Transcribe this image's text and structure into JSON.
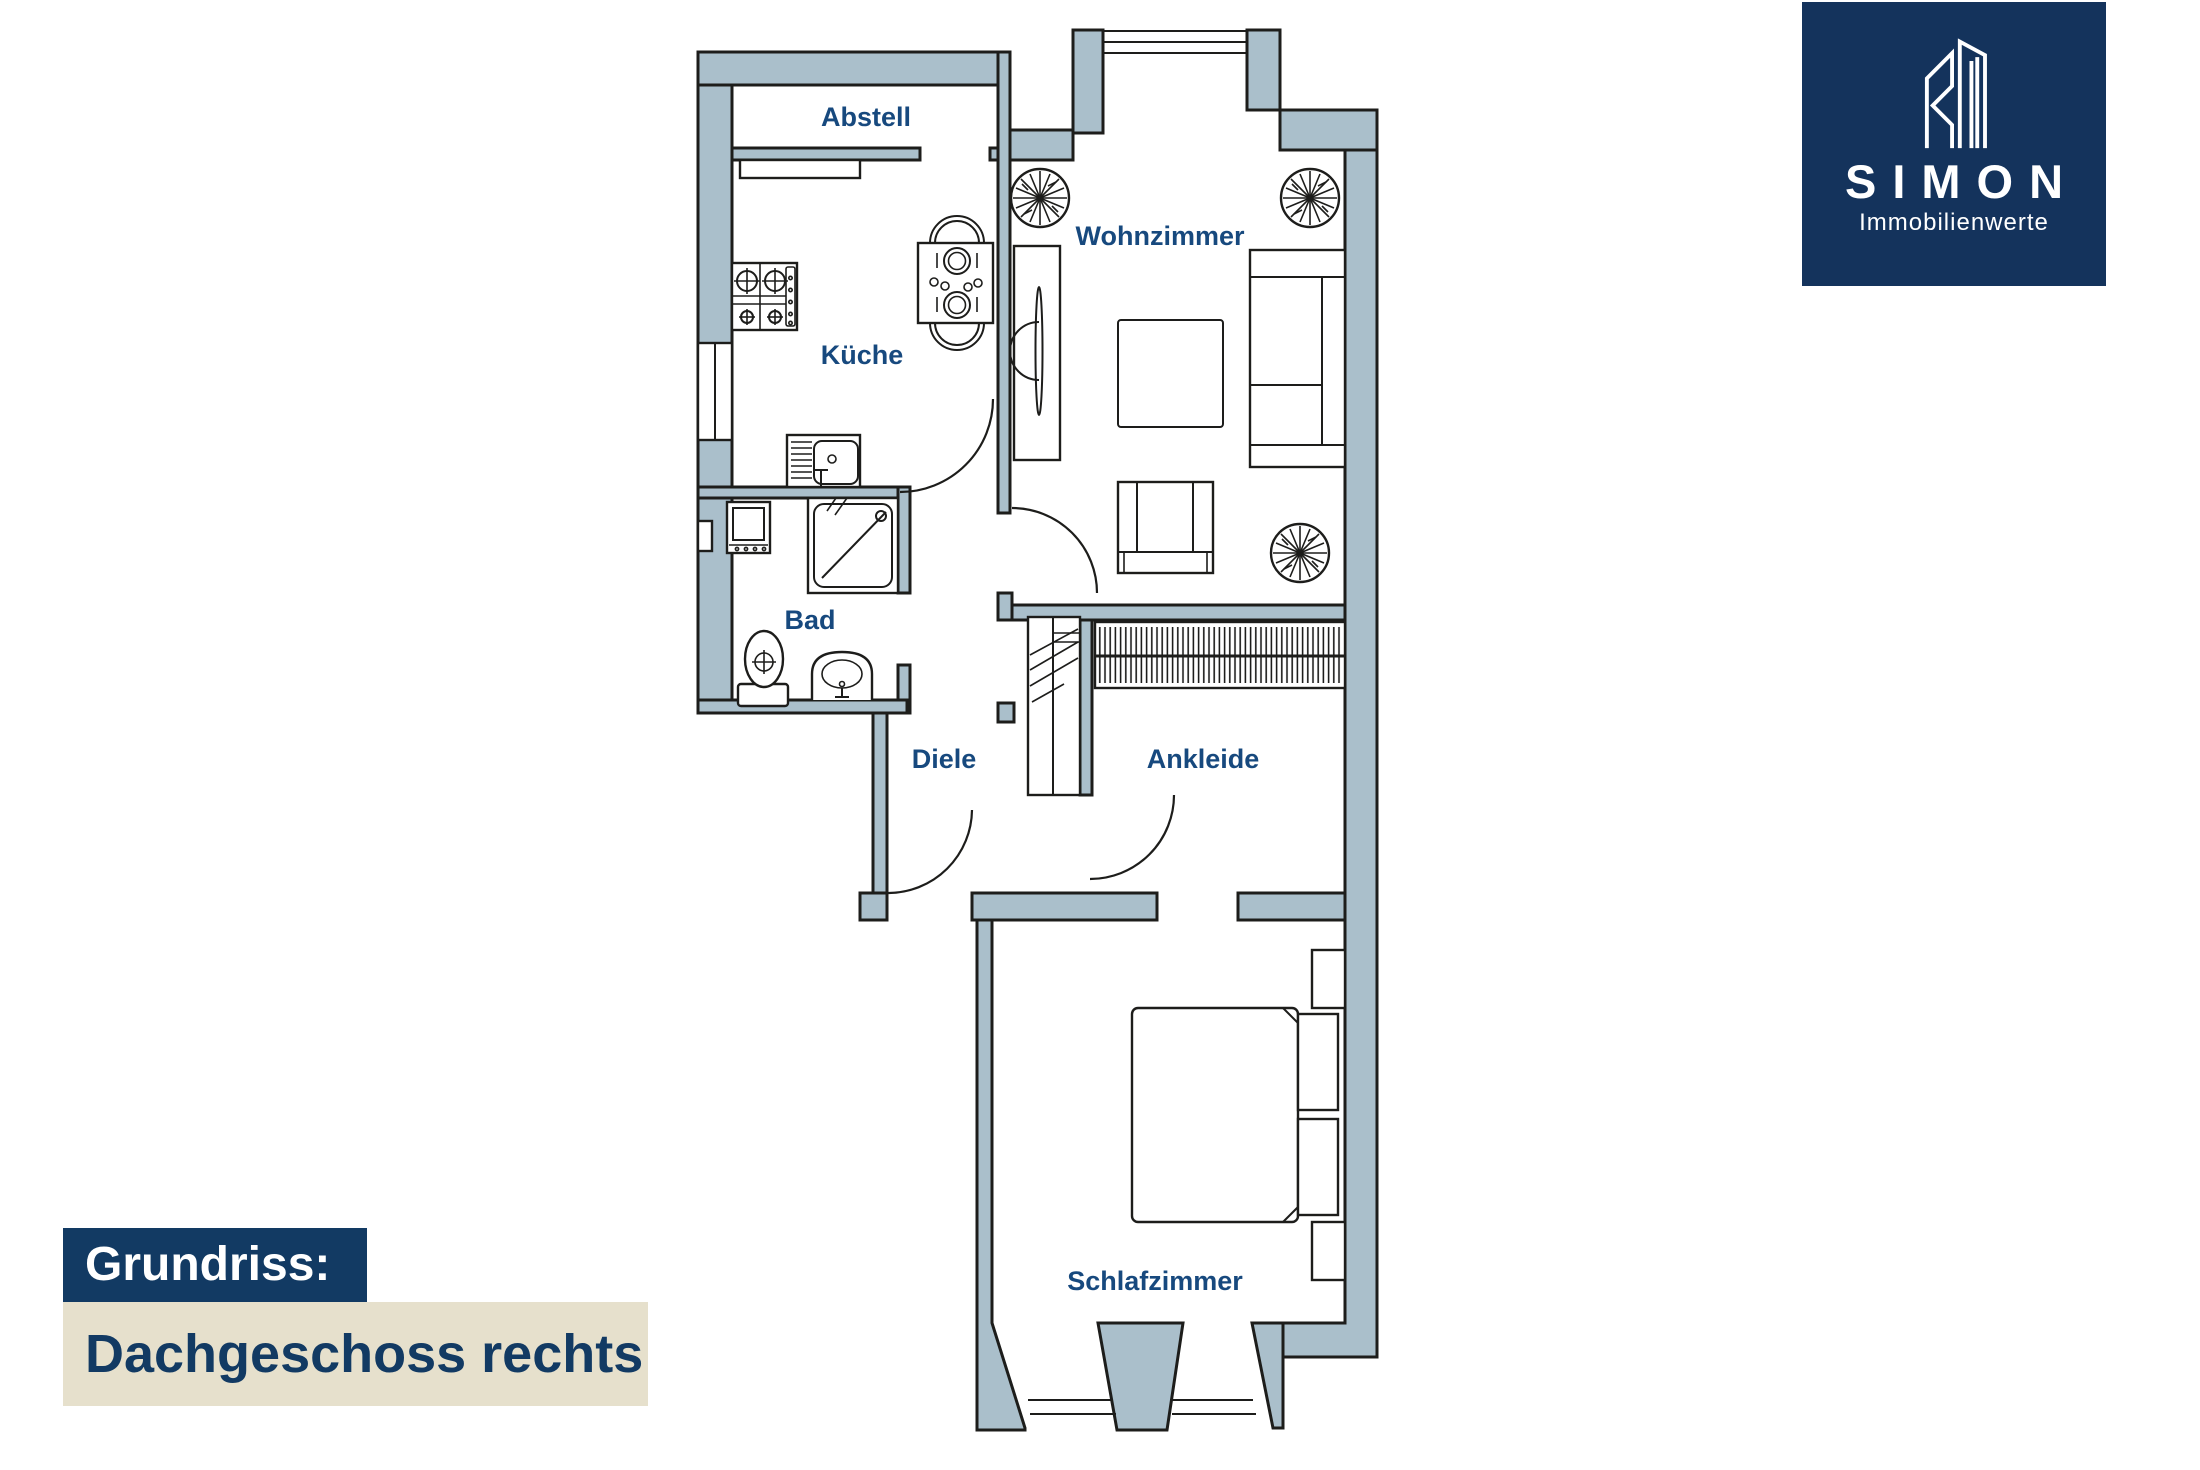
{
  "floorplan": {
    "rooms": [
      {
        "label": "Abstell"
      },
      {
        "label": "Wohnzimmer"
      },
      {
        "label": "Küche"
      },
      {
        "label": "Bad"
      },
      {
        "label": "Diele"
      },
      {
        "label": "Ankleide"
      },
      {
        "label": "Schlafzimmer"
      }
    ],
    "colors": {
      "wall": "#aabfcb",
      "outline": "#1d1d1b",
      "room_label": "#17497e"
    }
  },
  "logo": {
    "name": "SIMON",
    "subtitle": "Immobilienwerte",
    "bg_color": "#14335c",
    "text_color": "#ffffff"
  },
  "caption": {
    "line1": "Grundriss:",
    "line2": "Dachgeschoss rechts",
    "line1_bg": "#123a63",
    "line1_color": "#ffffff",
    "line2_bg": "#e6e0cc",
    "line2_color": "#123a63"
  }
}
